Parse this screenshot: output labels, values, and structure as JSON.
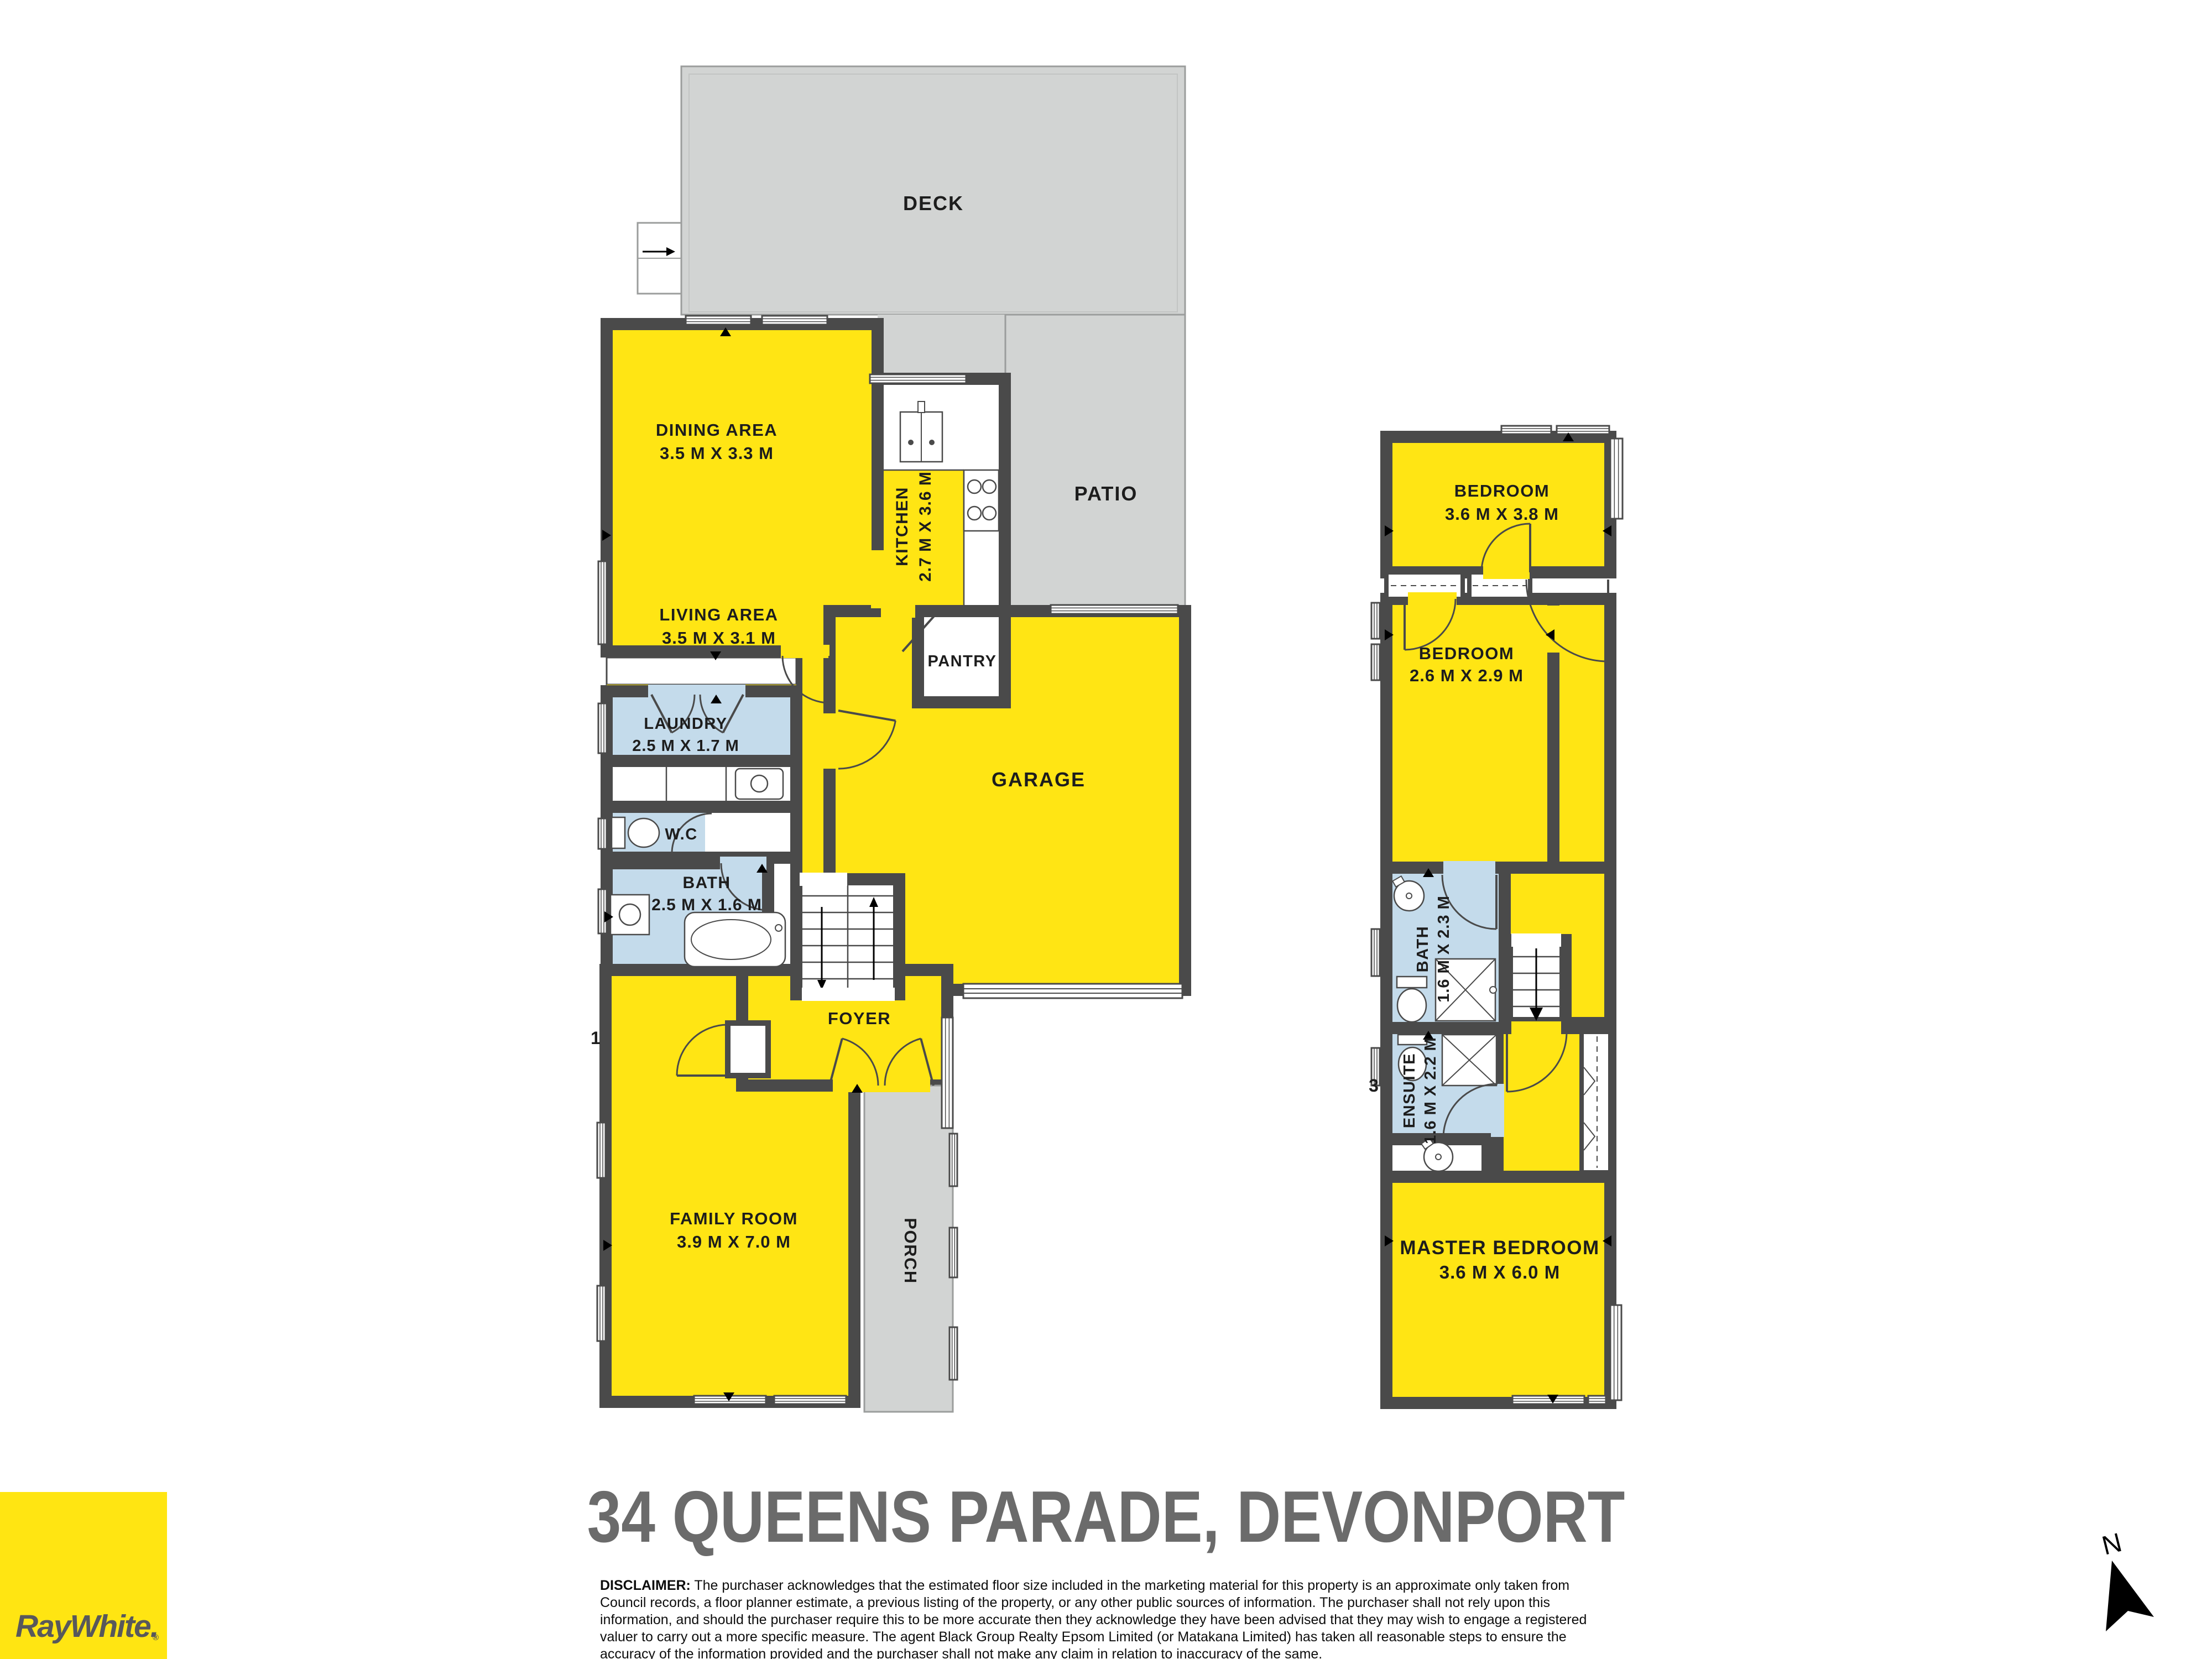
{
  "title": "34 QUEENS PARADE, DEVONPORT",
  "colors": {
    "room_yellow": "#FFE514",
    "wet_blue": "#C4DBEB",
    "outdoor_gray": "#D2D4D3",
    "wall_dark": "#4A4A4A",
    "brand_yellow": "#FFE512",
    "title_gray": "#6B6B6B",
    "logo_text": "#58585B"
  },
  "logo": {
    "brand": "RayWhite.",
    "registered": "®"
  },
  "north": {
    "label": "N"
  },
  "floor_numbers": {
    "ground": "1",
    "upper": "3"
  },
  "ground_floor": {
    "outdoor": {
      "deck": "DECK",
      "patio": "PATIO",
      "porch": "PORCH"
    },
    "rooms": {
      "dining": {
        "name": "DINING AREA",
        "dims": "3.5 M X 3.3 M"
      },
      "living": {
        "name": "LIVING AREA",
        "dims": "3.5 M X 3.1 M"
      },
      "kitchen": {
        "name": "KITCHEN",
        "dims": "2.7 M X 3.6 M"
      },
      "pantry": {
        "name": "PANTRY"
      },
      "laundry": {
        "name": "LAUNDRY",
        "dims": "2.5 M X 1.7 M"
      },
      "wc": {
        "name": "W.C"
      },
      "bath": {
        "name": "BATH",
        "dims": "2.5 M X 1.6 M"
      },
      "garage": {
        "name": "GARAGE"
      },
      "foyer": {
        "name": "FOYER"
      },
      "family": {
        "name": "FAMILY ROOM",
        "dims": "3.9 M X 7.0 M"
      }
    }
  },
  "upper_floor": {
    "rooms": {
      "bedroom1": {
        "name": "BEDROOM",
        "dims": "3.6 M X 3.8 M"
      },
      "bedroom2": {
        "name": "BEDROOM",
        "dims": "2.6 M X 2.9 M"
      },
      "bath": {
        "name": "BATH",
        "dims": "1.6 M X 2.3 M"
      },
      "ensuite": {
        "name": "ENSUITE",
        "dims": "1.6 M X 2.2 M"
      },
      "master": {
        "name": "MASTER BEDROOM",
        "dims": "3.6 M X 6.0 M"
      }
    }
  },
  "disclaimer": {
    "label": "DISCLAIMER:",
    "text": " The purchaser acknowledges that the estimated floor size included in the marketing material for this property is an approximate only taken from Council records, a floor planner estimate, a previous listing of the property, or any other public sources of information.  The purchaser shall not rely upon this information, and should the purchaser require this to be more accurate then they acknowledge they have been advised that they may wish to engage a registered valuer to carry out a more specific measure.  The agent Black Group Realty Epsom Limited (or Matakana Limited) has taken all reasonable steps to ensure the accuracy of the information provided and the purchaser shall not make any claim in relation to inaccuracy of the same."
  }
}
